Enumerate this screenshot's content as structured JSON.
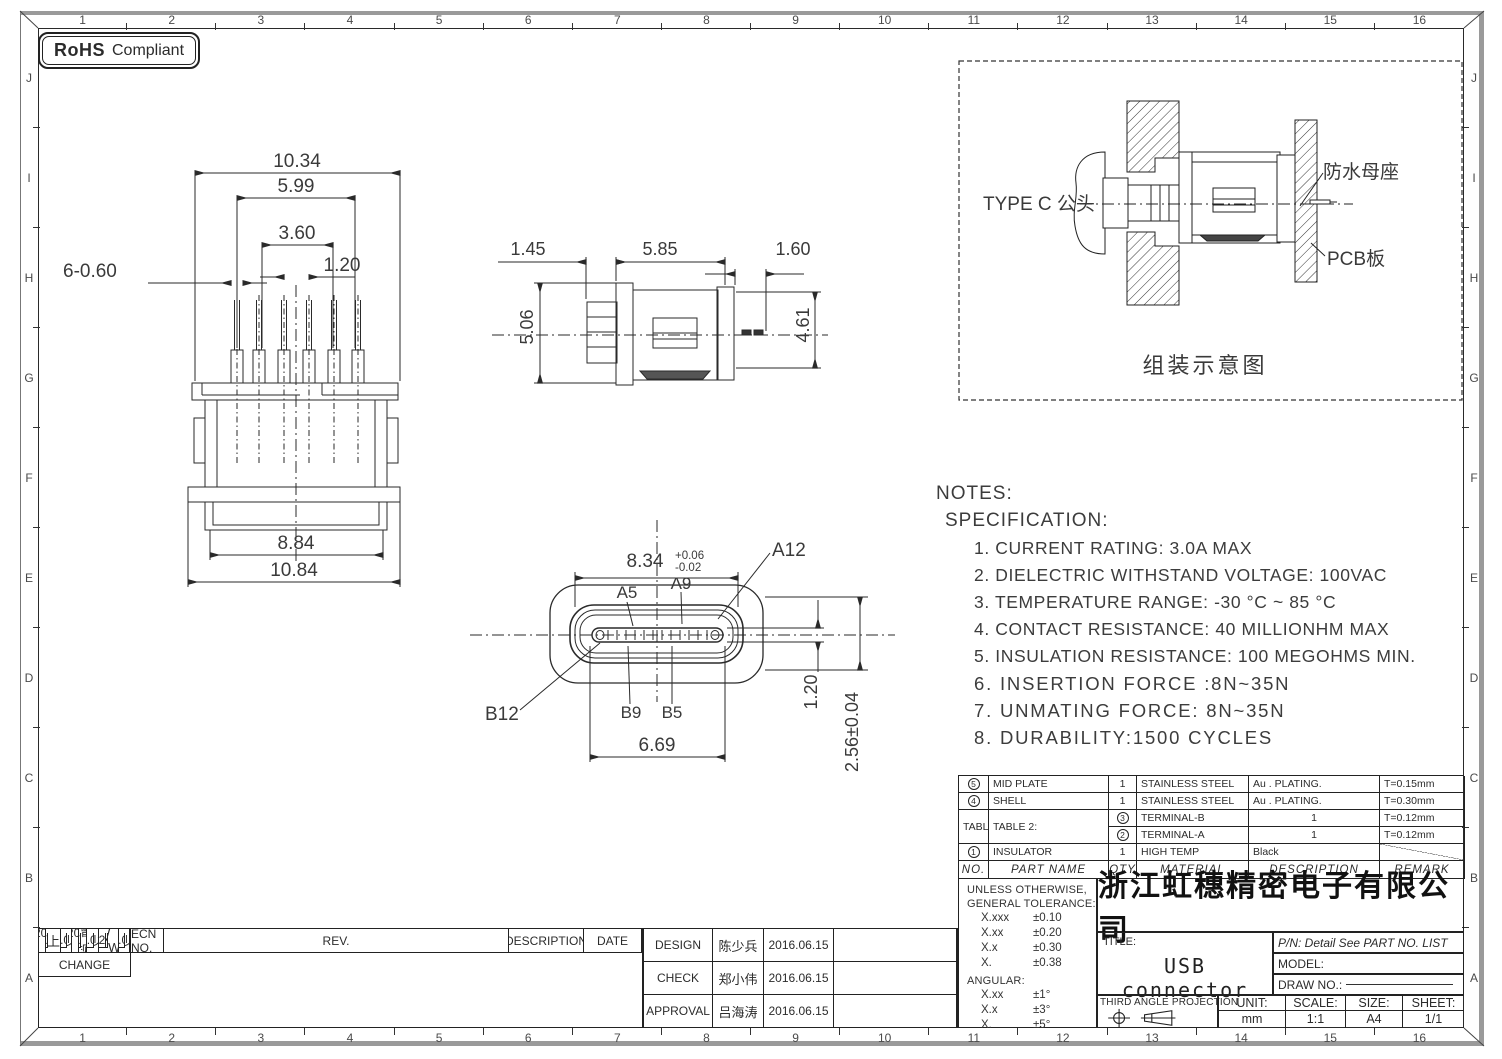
{
  "badge": {
    "rohs": "RoHS",
    "compliant": "Compliant"
  },
  "grid": {
    "cols": [
      "1",
      "2",
      "3",
      "4",
      "5",
      "6",
      "7",
      "8",
      "9",
      "10",
      "11",
      "12",
      "13",
      "14",
      "15",
      "16"
    ],
    "rows": [
      "J",
      "I",
      "H",
      "G",
      "F",
      "E",
      "D",
      "C",
      "B",
      "A"
    ]
  },
  "views": {
    "front": {
      "dims": {
        "total_top": "10.34",
        "pins_span": "5.99",
        "inner_span": "3.60",
        "pitch": "1.20",
        "pin_width": "6-0.60",
        "inner_bottom": "8.84",
        "total_bottom": "10.84"
      }
    },
    "side": {
      "dims": {
        "flange": "1.45",
        "body": "5.85",
        "tail": "1.60",
        "height": "5.06",
        "body_height": "4.61"
      }
    },
    "face": {
      "dims": {
        "width": "8.34",
        "tol_plus": "+0.06",
        "tol_minus": "-0.02",
        "tongue_width": "6.69",
        "tongue_thick": "1.20",
        "opening_height": "2.56±0.04"
      },
      "pins": {
        "a5": "A5",
        "a9": "A9",
        "a12": "A12",
        "b12": "B12",
        "b9": "B9",
        "b5": "B5"
      }
    },
    "assembly": {
      "label_plug": "TYPE C 公头",
      "label_receptacle": "防水母座",
      "label_pcb": "PCB板",
      "caption": "组装示意图"
    }
  },
  "notes": {
    "title": "NOTES:",
    "subtitle": "SPECIFICATION:",
    "items": [
      "1. CURRENT RATING: 3.0A MAX",
      "2. DIELECTRIC WITHSTAND VOLTAGE: 100VAC",
      "3. TEMPERATURE RANGE: -30 °C ~ 85 °C",
      "4. CONTACT RESISTANCE: 40 MILLIONHM MAX",
      "5. INSULATION RESISTANCE: 100 MEGOHMS MIN.",
      "6. INSERTION FORCE :8N~35N",
      "7. UNMATING FORCE: 8N~35N",
      "8. DURABILITY:1500 CYCLES"
    ]
  },
  "parts_table": {
    "headers": {
      "no": "NO.",
      "name": "PART NAME",
      "qty": "QTY",
      "material": "MATERIAL",
      "description": "DESCRIPTION",
      "remark": "REMARK"
    },
    "rows": [
      {
        "no": "5",
        "name": "MID PLATE",
        "qty": "1",
        "material": "STAINLESS STEEL",
        "description": "Au . PLATING.",
        "remark": "T=0.15mm"
      },
      {
        "no": "4",
        "name": "SHELL",
        "qty": "1",
        "material": "STAINLESS STEEL",
        "description": "Au . PLATING.",
        "remark": "T=0.30mm"
      },
      {
        "no": "3",
        "name": "TERMINAL-B",
        "qty": "1",
        "material": "TABLE 2:",
        "description": "TABLE 2:",
        "remark": "T=0.12mm"
      },
      {
        "no": "2",
        "name": "TERMINAL-A",
        "qty": "1",
        "material": "",
        "description": "",
        "remark": "T=0.12mm"
      },
      {
        "no": "1",
        "name": "INSULATOR",
        "qty": "1",
        "material": "HIGH TEMP",
        "description": "Black",
        "remark": ""
      }
    ]
  },
  "tolerance_block": {
    "heading1": "UNLESS OTHERWISE,",
    "heading2": "GENERAL TOLERANCE:",
    "linear": [
      {
        "k": "X.xxx",
        "v": "±0.10"
      },
      {
        "k": "X.xx",
        "v": "±0.20"
      },
      {
        "k": "X.x",
        "v": "±0.30"
      },
      {
        "k": "X.",
        "v": "±0.38"
      }
    ],
    "angular_label": "ANGULAR:",
    "angular": [
      {
        "k": "X.xx",
        "v": "±1°"
      },
      {
        "k": "X.x",
        "v": "±3°"
      },
      {
        "k": "X.",
        "v": "±5°"
      }
    ]
  },
  "title_block": {
    "company": "浙江虹穗精密电子有限公司",
    "title_label": "TITLE:",
    "title": "USB connector",
    "pn": "P/N: Detail See PART NO. LIST",
    "model_label": "MODEL:",
    "draw_no_label": "DRAW NO.:",
    "projection_label": "THIRD ANGLE PROJECTION",
    "unit_label": "UNIT:",
    "unit": "mm",
    "scale_label": "SCALE:",
    "scale": "1:1",
    "size_label": "SIZE:",
    "size": "A4",
    "sheet_label": "SHEET:",
    "sheet": "1/1"
  },
  "revision_table": {
    "headers": {
      "ecn": "ECN NO.",
      "rev": "REV.",
      "desc": "DESCRIPTION",
      "date": "DATE",
      "change": "CHANGE"
    },
    "rows": [
      {
        "ecn": "JH2016-080",
        "rev": "X2",
        "desc": "随工程图上升版本次",
        "date": "2016.06.15",
        "change": "陈少兵"
      },
      {
        "ecn": "JH2016-071",
        "rev": "X1",
        "desc": "新增规格",
        "date": "2016.06.10",
        "change": "陈少兵"
      },
      {
        "ecn": "20151224001",
        "rev": "X",
        "desc": "NEW DRAWING",
        "date": "2016.05.05",
        "change": "陈少兵"
      }
    ]
  },
  "approval_table": {
    "rows": [
      {
        "role": "DESIGN",
        "name": "陈少兵",
        "date": "2016.06.15"
      },
      {
        "role": "CHECK",
        "name": "郑小伟",
        "date": "2016.06.15"
      },
      {
        "role": "APPROVAL",
        "name": "吕海涛",
        "date": "2016.06.15"
      }
    ]
  }
}
